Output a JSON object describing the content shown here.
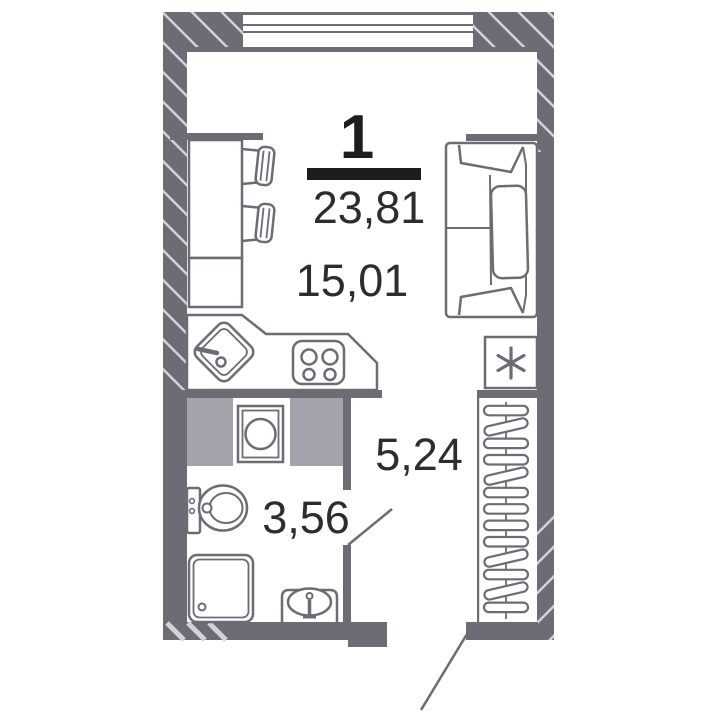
{
  "floor_plan": {
    "unit": {
      "number": "1",
      "total_area_m2": "23,81"
    },
    "areas": {
      "living_room": "15,01",
      "hallway": "5,24",
      "bathroom": "3,56"
    },
    "colors": {
      "walls": "#6b6c74",
      "hatch_lines": "#d2d3d9",
      "cabinet_fill": "#a3a4ab",
      "label_text": "#2c2d31",
      "unit_number_text": "#1d1d20",
      "background": "#ffffff"
    },
    "icons": {
      "fridge": "six-spoke-asterisk"
    }
  }
}
